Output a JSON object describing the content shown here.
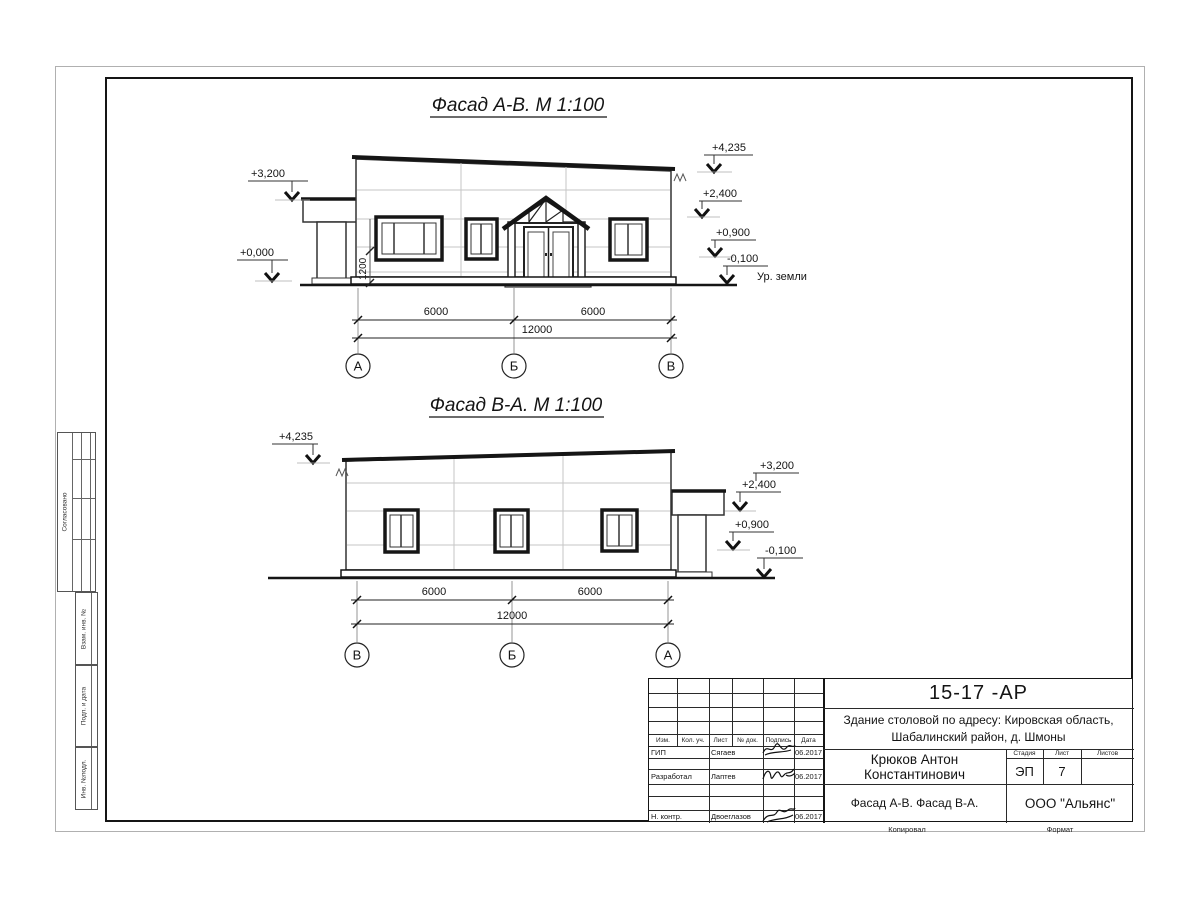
{
  "sheet": {
    "code": "15-17 -АР",
    "project_line1": "Здание столовой по адресу: Кировская область,",
    "project_line2": "Шабалинский район, д. Шмоны",
    "author": "Крюков Антон Константинович",
    "doc_title": "Фасад А-В. Фасад В-А.",
    "company": "ООО \"Альянс\"",
    "stage_label": "Стадия",
    "stage_value": "ЭП",
    "sheet_label": "Лист",
    "sheet_value": "7",
    "sheets_label": "Листов",
    "copied_label": "Копировал",
    "format_label": "Формат",
    "columns": [
      "Изм.",
      "Кол. уч.",
      "Лист",
      "№ док.",
      "Подпись",
      "Дата"
    ],
    "rows": [
      {
        "role": "ГИП",
        "name": "Сягаев",
        "date": "06.2017"
      },
      {
        "role": "Разработал",
        "name": "Лаптев",
        "date": "06.2017"
      },
      {
        "role": "Н. контр.",
        "name": "Двоеглазов",
        "date": "06.2017"
      }
    ],
    "margin": {
      "approved": "Согласовано",
      "vzam": "Взам. инв. №",
      "podp": "Подп. и дата",
      "inv": "Инв. №подл."
    }
  },
  "facade1": {
    "title": "Фасад А-В.  М 1:100",
    "marks": {
      "canopy_left": "+3,200",
      "zero": "+0,000",
      "roof": "+4,235",
      "door_top": "+2,400",
      "sill": "+0,900",
      "ground": "-0,100"
    },
    "ground_label": "Ур. земли",
    "window_height": "1200",
    "dims": {
      "left": "6000",
      "right": "6000",
      "total": "12000"
    },
    "axes": [
      "А",
      "Б",
      "В"
    ]
  },
  "facade2": {
    "title": "Фасад В-А.  М 1:100",
    "marks": {
      "roof": "+4,235",
      "canopy_top": "+3,200",
      "canopy_bottom": "+2,400",
      "sill": "+0,900",
      "ground": "-0,100"
    },
    "dims": {
      "left": "6000",
      "right": "6000",
      "total": "12000"
    },
    "axes": [
      "В",
      "Б",
      "А"
    ]
  }
}
